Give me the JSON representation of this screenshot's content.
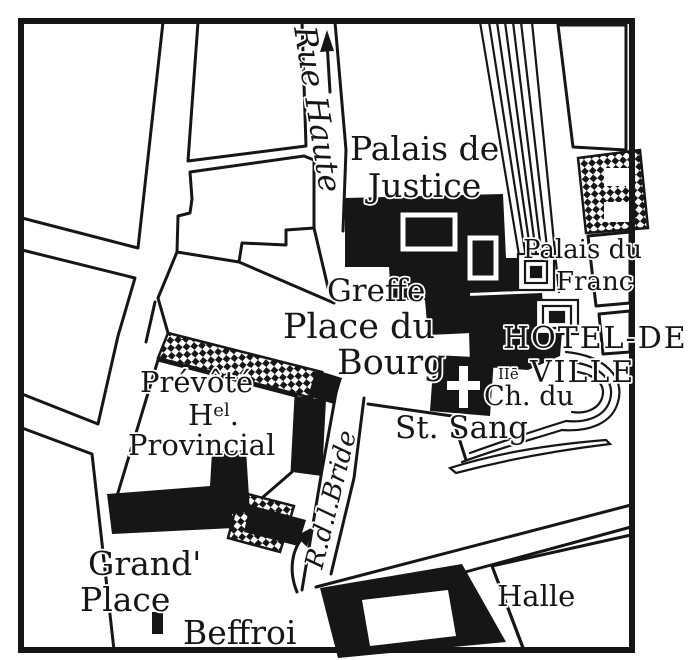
{
  "map": {
    "labels": {
      "rue_haute": "Rue Haute",
      "palais_de": "Palais de",
      "justice": "Justice",
      "palais_du": "Palais du",
      "franc": "Franc",
      "greffe": "Greffe",
      "place_du": "Place du",
      "bourg": "Bourg",
      "hotel_de": "HOTEL-DE",
      "ville": "VILLE",
      "ile_abbr": "IIē",
      "ch_du": "Ch. du",
      "st_sang": "St. Sang",
      "prevote": "Prévôté",
      "hotel_abbr_h": "H",
      "hotel_abbr_sup": "el",
      "hotel_abbr_dot": ".",
      "provincial": "Provincial",
      "grand": "Grand'",
      "place": "Place",
      "beffroi": "Beffroi",
      "halle": "Halle",
      "rue_de_la_bride": "R.d.l.Bride"
    },
    "icons": {
      "north_arrow": "up-arrow",
      "direction_arrow": "curved-up-arrow",
      "chapel_cross": "latin-cross",
      "beffroi_marker": "tower-footprint"
    },
    "colors": {
      "ink": "#161616",
      "paper": "#ffffff"
    },
    "legend": {
      "solid_black": "monument building",
      "checker": "hatched building",
      "stripes": "canal / multi-lane way"
    }
  }
}
